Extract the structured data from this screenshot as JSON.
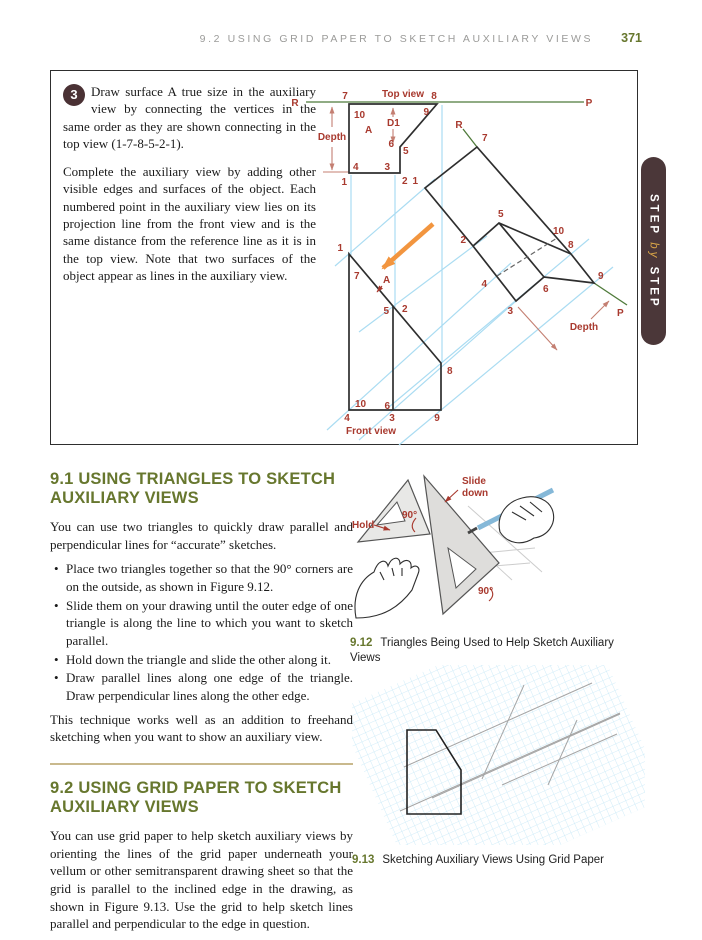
{
  "page": {
    "header": "9.2  USING GRID PAPER TO SKETCH AUXILIARY VIEWS",
    "page_number": "371"
  },
  "colors": {
    "accent_olive": "#67772e",
    "label_red": "#a8392e",
    "reference_green": "#4e7a3a",
    "projection_blue": "#aadcf2",
    "arrow_orange": "#f2953f",
    "tab_brown": "#4b3739",
    "tab_gold": "#d9a547",
    "divider_tan": "#c9b98d",
    "step_circle": "#4a3134"
  },
  "step_panel": {
    "step_number": "3",
    "para1": "Draw surface A true size in the auxiliary view by connecting the vertices in the same order as they are shown connecting in the top view (1-7-8-5-2-1).",
    "para2": "Complete the auxiliary view by adding other visible edges and surfaces of the object. Each numbered point in the auxiliary view lies on its projection line from the front view and is the same distance from the reference line as it is in the top view. Note that two surfaces of the object appear as lines in the auxiliary view.",
    "tab": {
      "top": "STEP",
      "mid": "by",
      "bottom": "STEP"
    },
    "diagram_labels": [
      {
        "t": "R",
        "x": 244,
        "y": 35,
        "a": "middle"
      },
      {
        "t": "Top view",
        "x": 352,
        "y": 26,
        "a": "middle",
        "n": "top-view-title"
      },
      {
        "t": "7",
        "x": 294,
        "y": 28,
        "a": "middle"
      },
      {
        "t": "8",
        "x": 383,
        "y": 28,
        "a": "middle"
      },
      {
        "t": "P",
        "x": 538,
        "y": 35,
        "a": "middle"
      },
      {
        "t": "10",
        "x": 303,
        "y": 47
      },
      {
        "t": "9",
        "x": 378,
        "y": 44,
        "a": "end"
      },
      {
        "t": "D1",
        "x": 336,
        "y": 55
      },
      {
        "t": "A",
        "x": 314,
        "y": 62
      },
      {
        "t": "Depth",
        "x": 281,
        "y": 69,
        "a": "middle"
      },
      {
        "t": "6",
        "x": 343,
        "y": 76,
        "a": "end"
      },
      {
        "t": "5",
        "x": 352,
        "y": 83
      },
      {
        "t": "4",
        "x": 302,
        "y": 99
      },
      {
        "t": "3",
        "x": 339,
        "y": 99,
        "a": "end"
      },
      {
        "t": "1",
        "x": 296,
        "y": 114,
        "a": "end"
      },
      {
        "t": "2",
        "x": 351,
        "y": 113
      },
      {
        "t": "1",
        "x": 292,
        "y": 180,
        "a": "end"
      },
      {
        "t": "7",
        "x": 303,
        "y": 208
      },
      {
        "t": "A",
        "x": 332,
        "y": 212
      },
      {
        "t": "5",
        "x": 338,
        "y": 243,
        "a": "end"
      },
      {
        "t": "2",
        "x": 351,
        "y": 241
      },
      {
        "t": "8",
        "x": 396,
        "y": 303
      },
      {
        "t": "10",
        "x": 304,
        "y": 336
      },
      {
        "t": "6",
        "x": 339,
        "y": 338,
        "a": "end"
      },
      {
        "t": "4",
        "x": 296,
        "y": 350,
        "a": "middle"
      },
      {
        "t": "3",
        "x": 341,
        "y": 350,
        "a": "middle"
      },
      {
        "t": "9",
        "x": 386,
        "y": 350,
        "a": "middle"
      },
      {
        "t": "Front view",
        "x": 320,
        "y": 363,
        "a": "middle",
        "n": "front-view-title"
      },
      {
        "t": "R",
        "x": 408,
        "y": 57,
        "a": "middle"
      },
      {
        "t": "7",
        "x": 431,
        "y": 70
      },
      {
        "t": "1",
        "x": 367,
        "y": 113,
        "a": "end"
      },
      {
        "t": "5",
        "x": 447,
        "y": 146
      },
      {
        "t": "2",
        "x": 415,
        "y": 172,
        "a": "end"
      },
      {
        "t": "10",
        "x": 502,
        "y": 163
      },
      {
        "t": "8",
        "x": 517,
        "y": 177
      },
      {
        "t": "9",
        "x": 547,
        "y": 208
      },
      {
        "t": "6",
        "x": 492,
        "y": 221
      },
      {
        "t": "4",
        "x": 436,
        "y": 216,
        "a": "end"
      },
      {
        "t": "3",
        "x": 462,
        "y": 243,
        "a": "end"
      },
      {
        "t": "P",
        "x": 566,
        "y": 245
      },
      {
        "t": "Depth",
        "x": 533,
        "y": 259,
        "a": "middle"
      }
    ]
  },
  "section_91": {
    "heading": "9.1  USING TRIANGLES TO SKETCH AUXILIARY VIEWS",
    "intro": "You can use two triangles to quickly draw parallel and perpendicular lines for “accurate” sketches.",
    "bullets": [
      "Place two triangles together so that the 90° corners are on the outside, as shown in Figure 9.12.",
      "Slide them on your drawing until the outer edge of one triangle is along the line to which you want to sketch parallel.",
      "Hold down the triangle and slide the other along it.",
      "Draw parallel lines along one edge of the triangle. Draw perpendicular lines along the other edge."
    ],
    "outro": "This technique works well as an addition to freehand sketching when you want to show an auxiliary view."
  },
  "section_92": {
    "heading": "9.2  USING GRID PAPER TO SKETCH AUXILIARY VIEWS",
    "body": "You can use grid paper to help sketch auxiliary views by orienting the lines of the grid paper underneath your vellum or other semitransparent drawing sheet so that the grid is parallel to the inclined edge in the drawing, as shown in Figure 9.13. Use the grid to help sketch lines parallel and perpendicular to the edge in question."
  },
  "fig_912": {
    "number": "9.12",
    "caption": "Triangles Being Used to Help Sketch Auxiliary Views",
    "labels": [
      {
        "t": "Slide",
        "x": 112,
        "y": 16
      },
      {
        "t": "down",
        "x": 112,
        "y": 28
      },
      {
        "t": "Hold",
        "x": 2,
        "y": 60
      },
      {
        "t": "90°",
        "x": 52,
        "y": 50
      },
      {
        "t": "90°",
        "x": 128,
        "y": 126
      }
    ]
  },
  "fig_913": {
    "number": "9.13",
    "caption": "Sketching Auxiliary Views Using Grid Paper"
  }
}
